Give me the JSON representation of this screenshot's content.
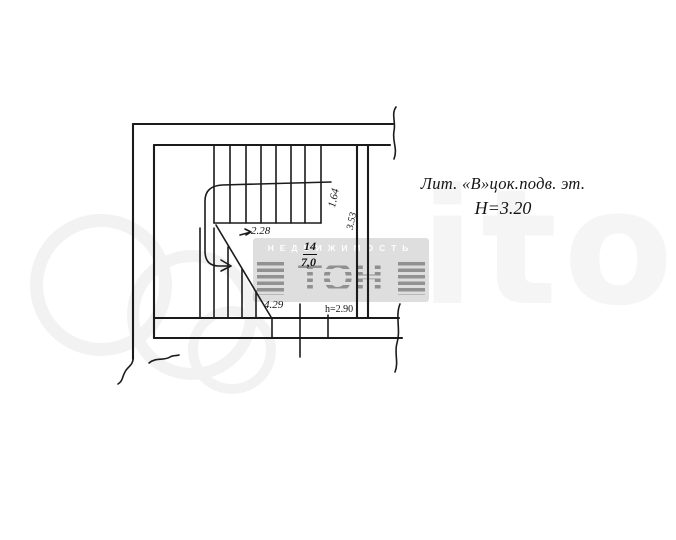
{
  "plan": {
    "litera_line": "Лит. «В»цок.подв. эт.",
    "height_line": "Н=3.20",
    "room_number": "14",
    "room_area": "7,0",
    "dim_upper_flight": "1.64",
    "dim_landing": "3.53",
    "dim_upper_run": "2.28",
    "dim_lower_run": "4.29",
    "dim_room_height": "h=2.90"
  },
  "watermark": {
    "realty_text": "НЕДВИЖИМОСТЬ",
    "logo_text": "ТОН",
    "site_text": "ito"
  }
}
